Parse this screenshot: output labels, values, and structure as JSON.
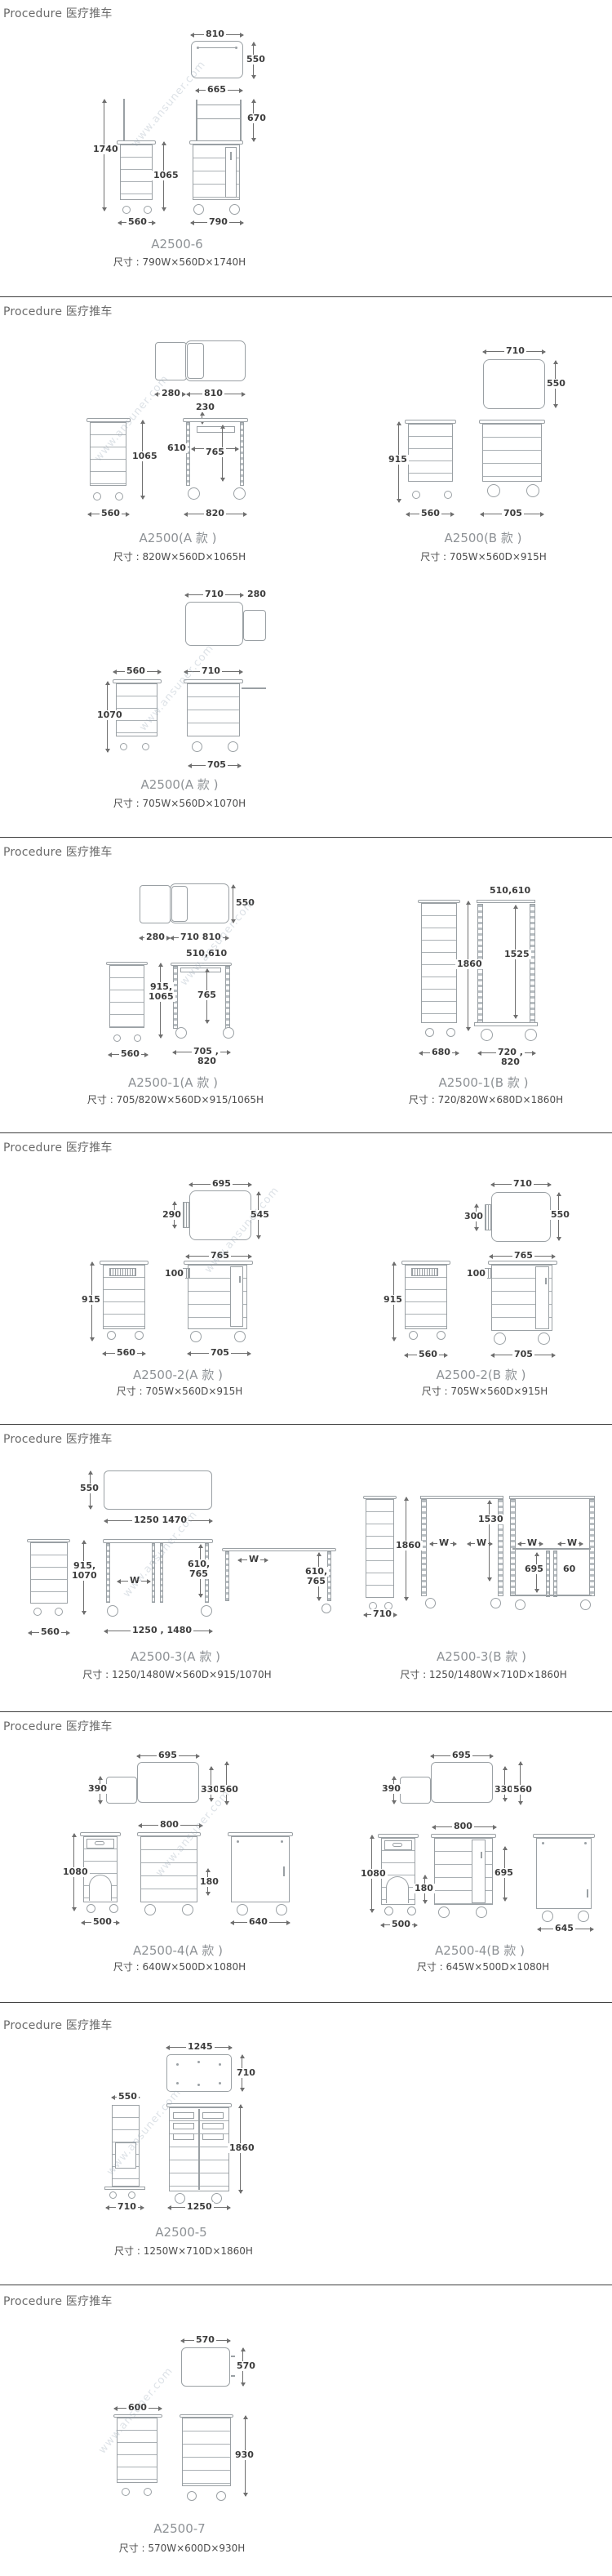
{
  "header_label": "Procedure 医疗推车",
  "watermark": "www.ansuner.com",
  "colors": {
    "drawing_line": "#9aa0a4",
    "dim_text": "#3c3c3c",
    "divider": "#3f3f3f",
    "caption": "#8e9296",
    "size_text": "#4c4c4c"
  },
  "sections": [
    {
      "figures": [
        {
          "model": "A2500-6",
          "size": "尺寸 : 790W×560D×1740H",
          "dims": {
            "top_w": "810",
            "top_d": "550",
            "frame_w": "665",
            "frame_h": "670",
            "h_total": "1740",
            "h_body": "1065",
            "w_side": "560",
            "w_front": "790"
          }
        }
      ]
    },
    {
      "figures": [
        {
          "model": "A2500(A 款 )",
          "size": "尺寸 : 820W×560D×1065H",
          "dims": {
            "ext": "280",
            "top_w": "810",
            "tray": "230",
            "h_body": "1065",
            "w_side": "560",
            "inner_w": "610",
            "inner_h": "765",
            "w_front": "820"
          }
        },
        {
          "model": "A2500(B 款 )",
          "size": "尺寸 : 705W×560D×915H",
          "dims": {
            "top_w": "710",
            "top_d": "550",
            "h_body": "915",
            "w_side": "560",
            "w_front": "705"
          }
        },
        {
          "model": "A2500(A 款 )",
          "size": "尺寸 : 705W×560D×1070H",
          "dims": {
            "top_w": "710",
            "ext": "280",
            "w_side": "560",
            "top2_w": "710",
            "h_body": "1070",
            "w_front": "705"
          }
        }
      ]
    },
    {
      "figures": [
        {
          "model": "A2500-1(A 款 )",
          "size": "尺寸 : 705/820W×560D×915/1065H",
          "dims": {
            "ext": "280",
            "top_w": "710 810",
            "top_d": "550",
            "rail_w": "510,610",
            "inner_h": "765",
            "h1": "915,",
            "h2": "1065",
            "w_side": "560",
            "f1": "705 ,",
            "f2": "820"
          }
        },
        {
          "model": "A2500-1(B 款 )",
          "size": "尺寸 : 720/820W×680D×1860H",
          "dims": {
            "rail_w": "510,610",
            "h_total": "1860",
            "inner_h": "1525",
            "w_side": "680",
            "f1": "720 ,",
            "f2": "820"
          }
        }
      ]
    },
    {
      "figures": [
        {
          "model": "A2500-2(A 款 )",
          "size": "尺寸 : 705W×560D×915H",
          "dims": {
            "top_w": "695",
            "top_d": "545",
            "vent_d": "290",
            "inner_w": "765",
            "vent_h": "100",
            "h_body": "915",
            "w_side": "560",
            "w_front": "705"
          }
        },
        {
          "model": "A2500-2(B 款 )",
          "size": "尺寸 : 705W×560D×915H",
          "dims": {
            "top_w": "710",
            "top_d": "550",
            "vent_d": "300",
            "inner_w": "765",
            "vent_h": "100",
            "h_body": "915",
            "w_side": "560",
            "w_front": "705"
          }
        }
      ]
    },
    {
      "figures": [
        {
          "model": "A2500-3(A 款 )",
          "size": "尺寸 : 1250/1480W×560D×915/1070H",
          "dims": {
            "top_d": "550",
            "top_w": "1250 1470",
            "h1": "915,",
            "h2": "1070",
            "w_side": "560",
            "w1": "W",
            "i1": "610,",
            "i2": "765",
            "w_front": "1250 , 1480",
            "w2": "W",
            "j1": "610,",
            "j2": "765"
          }
        },
        {
          "model": "A2500-3(B 款 )",
          "size": "尺寸 : 1250/1480W×710D×1860H",
          "dims": {
            "h_total": "1860",
            "w_side": "710",
            "inner_h": "1530",
            "w1": "W",
            "w2": "W",
            "w3": "W",
            "w4": "W",
            "shelf_h": "695",
            "gap": "60"
          }
        }
      ]
    },
    {
      "figures": [
        {
          "model": "A2500-4(A 款 )",
          "size": "尺寸 : 640W×500D×1080H",
          "dims": {
            "top_w": "695",
            "ext_d": "390",
            "d1": "330",
            "d2": "560",
            "front_w": "800",
            "h_total": "1080",
            "base_h": "180",
            "w_side": "500",
            "w_right": "640"
          }
        },
        {
          "model": "A2500-4(B 款 )",
          "size": "尺寸 : 645W×500D×1080H",
          "dims": {
            "top_w": "695",
            "ext_d": "390",
            "d1": "330",
            "d2": "560",
            "front_w": "800",
            "h_total": "1080",
            "base_h": "180",
            "door_h": "695",
            "w_side": "500",
            "w_right": "645"
          }
        }
      ]
    },
    {
      "figures": [
        {
          "model": "A2500-5",
          "size": "尺寸 : 1250W×710D×1860H",
          "dims": {
            "top_w": "1245",
            "top_d": "710",
            "side_top": "550",
            "w_side": "710",
            "h_total": "1860",
            "w_front": "1250"
          }
        }
      ]
    },
    {
      "figures": [
        {
          "model": "A2500-7",
          "size": "尺寸 : 570W×600D×930H",
          "dims": {
            "top_w": "570",
            "top_d": "570",
            "w_side": "600",
            "h_total": "930"
          }
        }
      ]
    }
  ]
}
